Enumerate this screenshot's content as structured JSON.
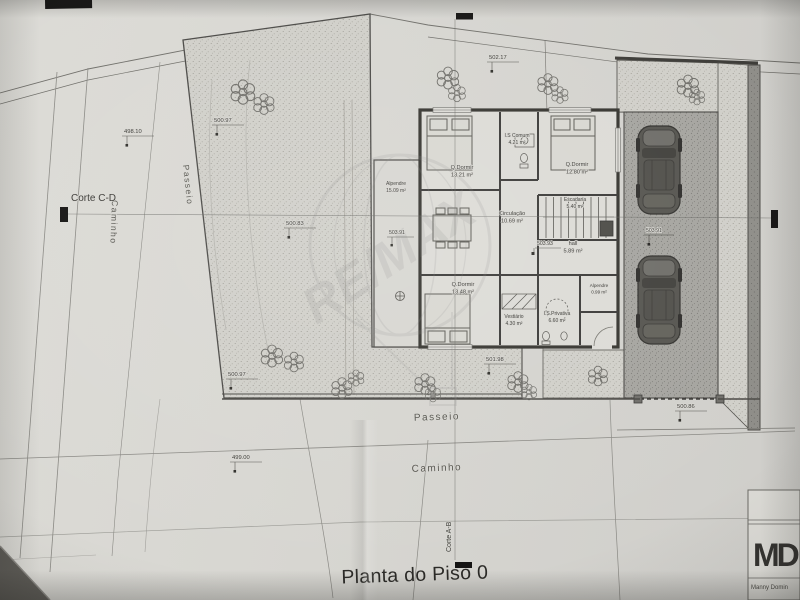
{
  "title": "Planta do Piso 0",
  "watermark_text": "RE/MAX",
  "section_labels": {
    "cd": "Corte C-D",
    "ab": "Corte A-B"
  },
  "street_labels": {
    "passeio_left": "Passeio",
    "caminho_left": "Caminho",
    "passeio_bottom": "Passeio",
    "caminho_bottom": "Caminho"
  },
  "elevation_marks": {
    "top_left": "498.10",
    "garden_top": "500.97",
    "street_top": "502.17",
    "garden_mid": "500.83",
    "porch_left": "503.91",
    "hall": "503.93",
    "garage": "503.91",
    "entrance": "501.98",
    "garden_bottom": "500.97",
    "road_bottom": "499.00",
    "sidewalk_right": "500.86"
  },
  "rooms": {
    "bedroom1": {
      "name": "Q.Dormir",
      "area": "13.21 m²"
    },
    "wc_common": {
      "name": "I.S Comum",
      "area": "4.21 m²"
    },
    "bedroom2": {
      "name": "Q.Dormir",
      "area": "12.80 m²"
    },
    "porch_left": {
      "name": "Alpendre",
      "area": "15.09 m²"
    },
    "circulation": {
      "name": "Circulação",
      "area": "10.69 m²"
    },
    "stairs": {
      "name": "Escadaria",
      "area": "5.40 m²"
    },
    "hall": {
      "name": "hall",
      "area": "5.89 m²"
    },
    "bedroom3": {
      "name": "Q.Dormir",
      "area": "13.48 m²"
    },
    "dressing": {
      "name": "Vestiário",
      "area": "4.30 m²"
    },
    "wc_private": {
      "name": "I.S.Privativa",
      "area": "6.60 m²"
    },
    "porch_right": {
      "name": "Alpendre",
      "area": "0.99 m²"
    }
  },
  "title_block": {
    "logo": "MD",
    "name": "Manny Domin"
  }
}
